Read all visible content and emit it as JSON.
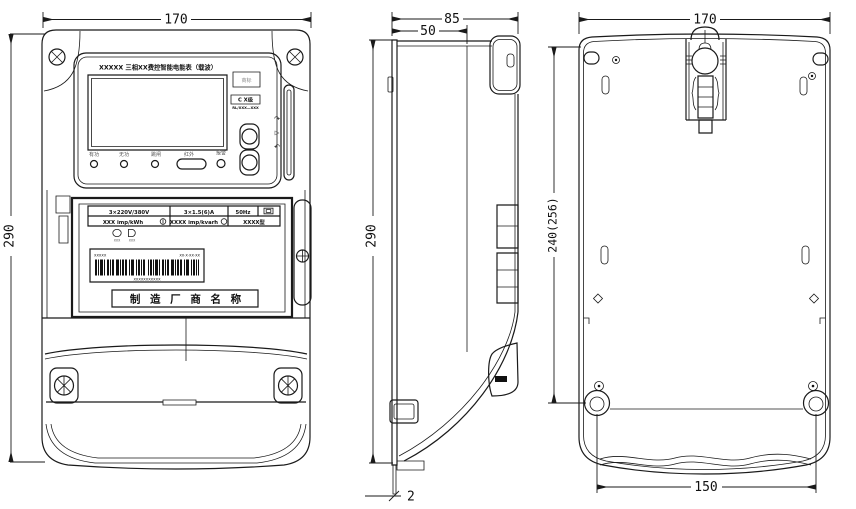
{
  "colors": {
    "line": "#1a1a1a",
    "background": "#ffffff"
  },
  "dimensions": {
    "front_width": "170",
    "front_height": "290",
    "side_depth": "85",
    "side_front_depth": "50",
    "side_height": "290",
    "side_base_offset": "2",
    "back_width": "170",
    "back_mount_vertical": "240(256)",
    "back_mount_span": "150"
  },
  "front_view": {
    "title": "XXXXX 三相XX费控智能电能表（载波）",
    "trademark": "商标",
    "accuracy_class": "C X级",
    "standard_code": "RL/XXX—XXX",
    "led_labels": [
      "有功",
      "无功",
      "跳闸",
      "红外",
      "报警"
    ],
    "card_slot_icons": [
      "↷",
      "▷",
      "↶"
    ],
    "nameplate": {
      "voltage": "3×220V/380V",
      "current": "3×1.5(6)A",
      "frequency": "50Hz",
      "active_constant": "XXX imp/kWh",
      "reactive_constant": "XXXX imp/kvarh",
      "model": "XXXX型",
      "seal_left": "XXX",
      "seal_right": "XXX",
      "barcode_top_left": "XXXXX",
      "barcode_top_right": "XX·X·XX·XX",
      "barcode_number": "XXXXXXXXXXX",
      "manufacturer": "制 造 厂 商 名 称"
    }
  }
}
